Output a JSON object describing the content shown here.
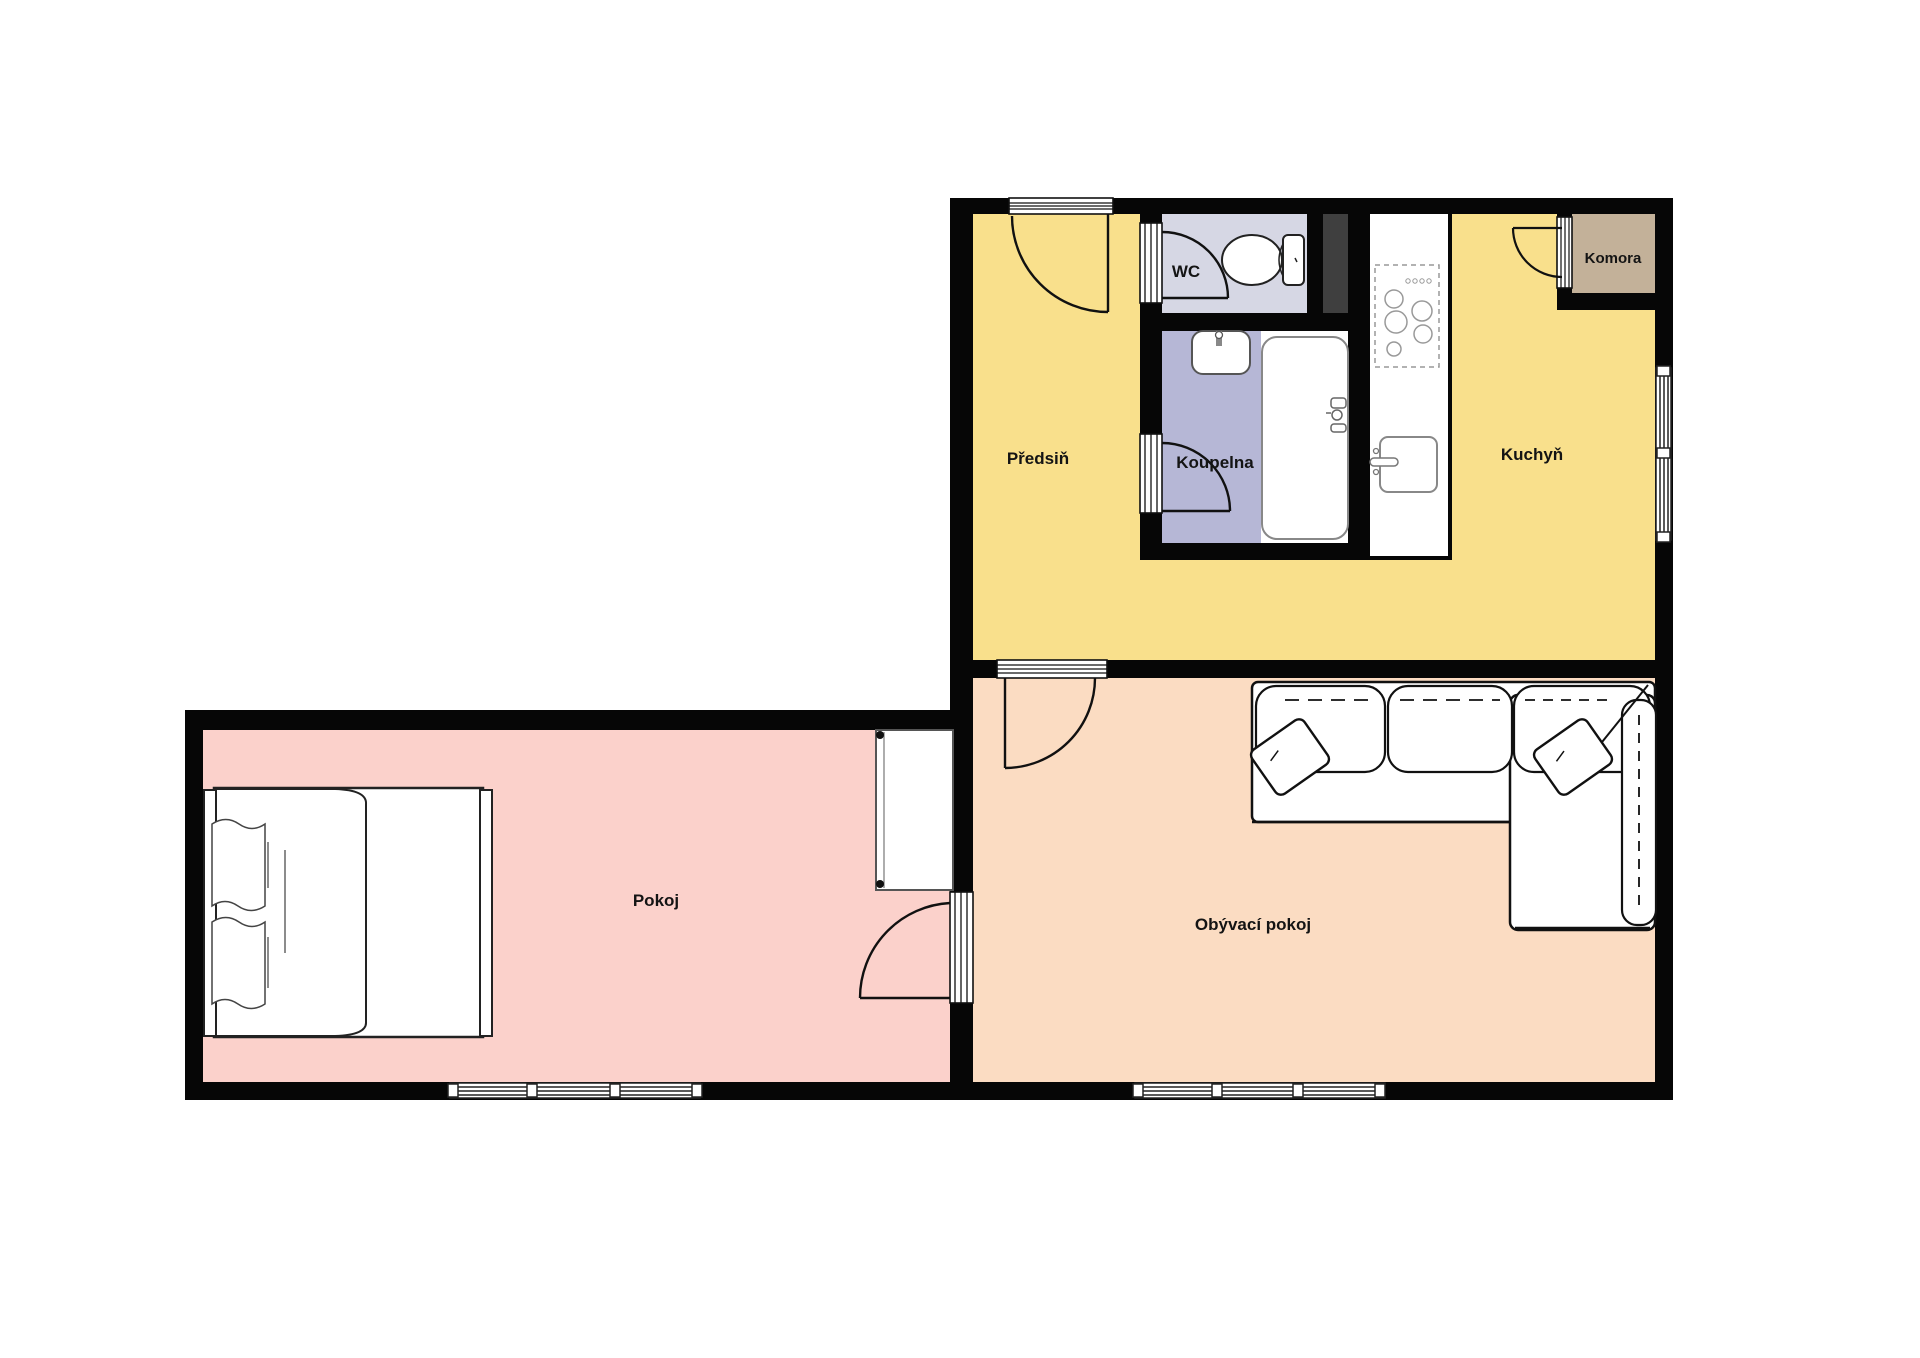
{
  "floorplan": {
    "rooms": [
      {
        "id": "predsin",
        "label": "Předsiň",
        "color": "#F9E08C"
      },
      {
        "id": "wc",
        "label": "WC",
        "color": "#D6D7E4"
      },
      {
        "id": "koupelna",
        "label": "Koupelna",
        "color": "#B6B7D6"
      },
      {
        "id": "kuchyn",
        "label": "Kuchyň",
        "color": "#F9E08C"
      },
      {
        "id": "komora",
        "label": "Komora",
        "color": "#C3B199"
      },
      {
        "id": "pokoj",
        "label": "Pokoj",
        "color": "#FBD1CB"
      },
      {
        "id": "obyvaci",
        "label": "Obývací pokoj",
        "color": "#FBDCC2"
      }
    ],
    "colors": {
      "wall": "#060606",
      "shaft": "#3F3F3F",
      "background": "#FFFFFF",
      "furniture_fill": "#FFFFFF",
      "furniture_outline": "#1A1A1A"
    },
    "furniture_icons": [
      "double-bed-icon",
      "wardrobe-icon",
      "corner-sofa-icon",
      "toilet-icon",
      "washbasin-icon",
      "bathtub-icon",
      "kitchen-counter-icon",
      "stove-icon",
      "kitchen-sink-icon",
      "ventilation-shaft-icon"
    ]
  }
}
